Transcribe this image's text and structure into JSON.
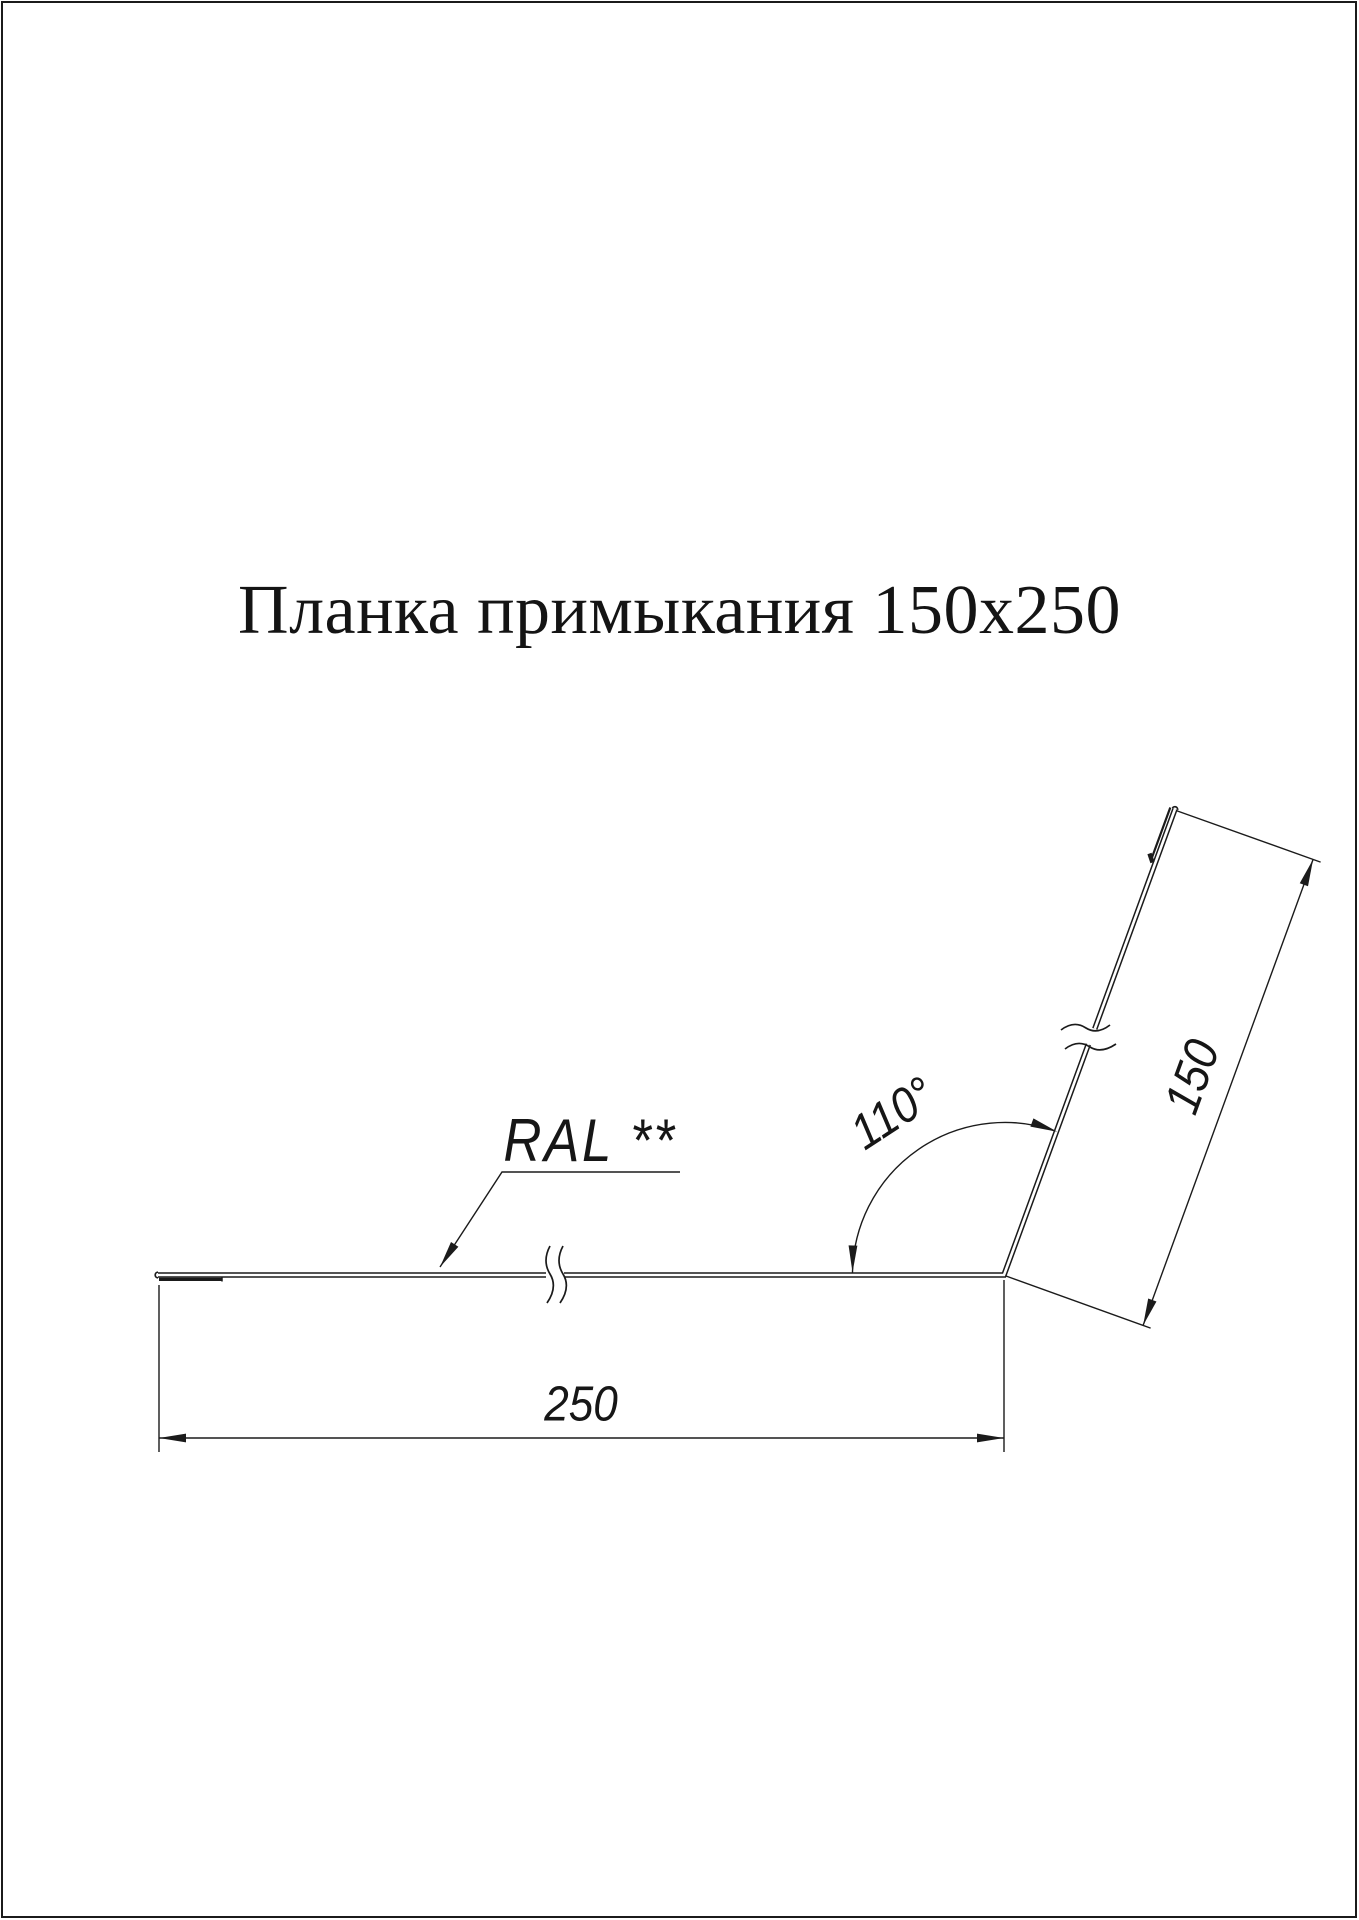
{
  "page": {
    "background": "#ffffff",
    "border_color": "#1b1b1b",
    "line_color": "#1b1b1b"
  },
  "title": "Планка примыкания 150x250",
  "drawing": {
    "kind": "profile-cross-section",
    "labels": {
      "ral": "RAL **",
      "angle": "110°",
      "dim_flange": "150",
      "dim_base": "250"
    },
    "dimensions": {
      "flange_mm": 150,
      "base_mm": 250,
      "bend_angle_deg": 110
    }
  }
}
